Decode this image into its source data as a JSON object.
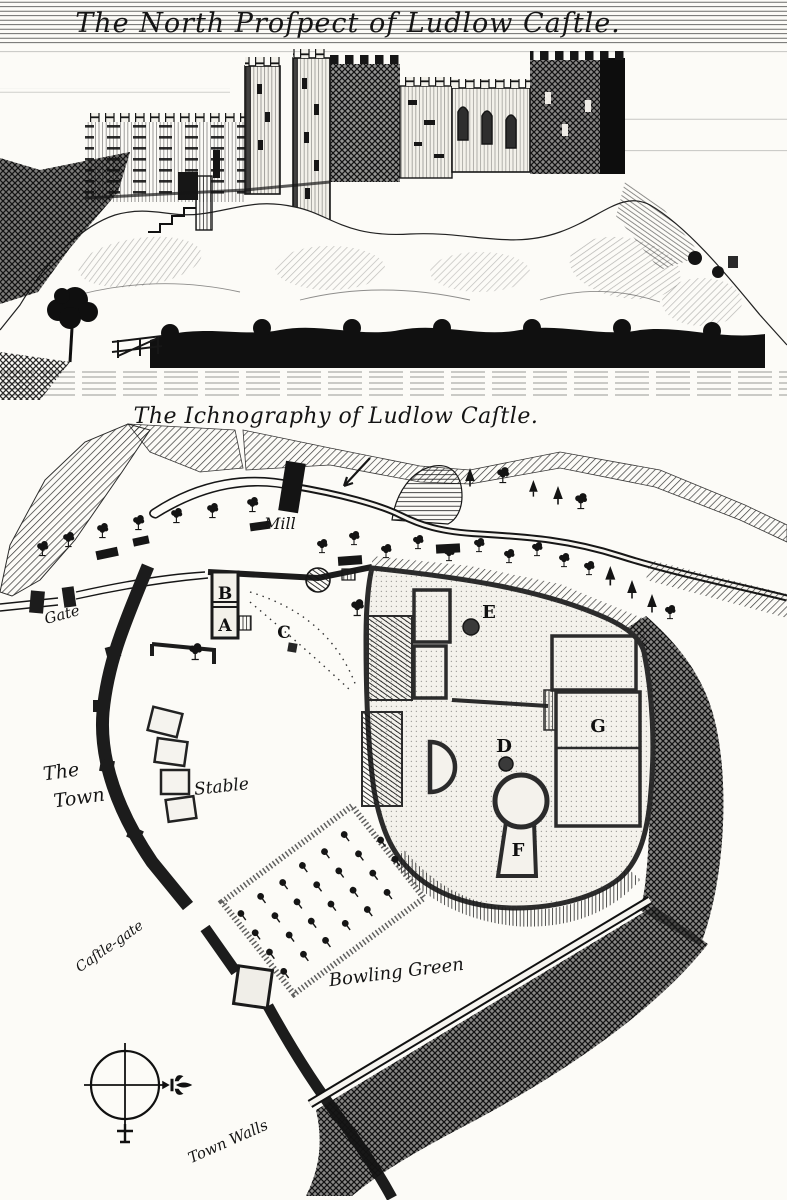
{
  "colors": {
    "ink": "#161616",
    "paper": "#fcfbf7",
    "wall_light": "#f3f1ea"
  },
  "prospect": {
    "title": "The North Proſpect of Ludlow Caſtle."
  },
  "ichnography": {
    "title": "The Ichnography of Ludlow Caſtle.",
    "labels": {
      "mill": "Mill",
      "gate": "Gate",
      "town_line1": "The",
      "town_line2": "Town",
      "stable": "Stable",
      "castle_gate": "Caſtle-gate",
      "bowling_green": "Bowling Green",
      "town_walls": "Town Walls"
    },
    "markers": {
      "a": "A",
      "b": "B",
      "c": "C",
      "d": "D",
      "e": "E",
      "f": "F",
      "g": "G"
    },
    "icons": {
      "compass": "compass-rose",
      "north_pointer": "fleur-de-lis",
      "south_pointer": "cross",
      "tree": "deciduous-tree",
      "conifer": "conifer-tree",
      "orchard_tree": "orchard-tree",
      "mill_building": "mill-block",
      "flow_arrow": "river-flow-arrow"
    }
  }
}
